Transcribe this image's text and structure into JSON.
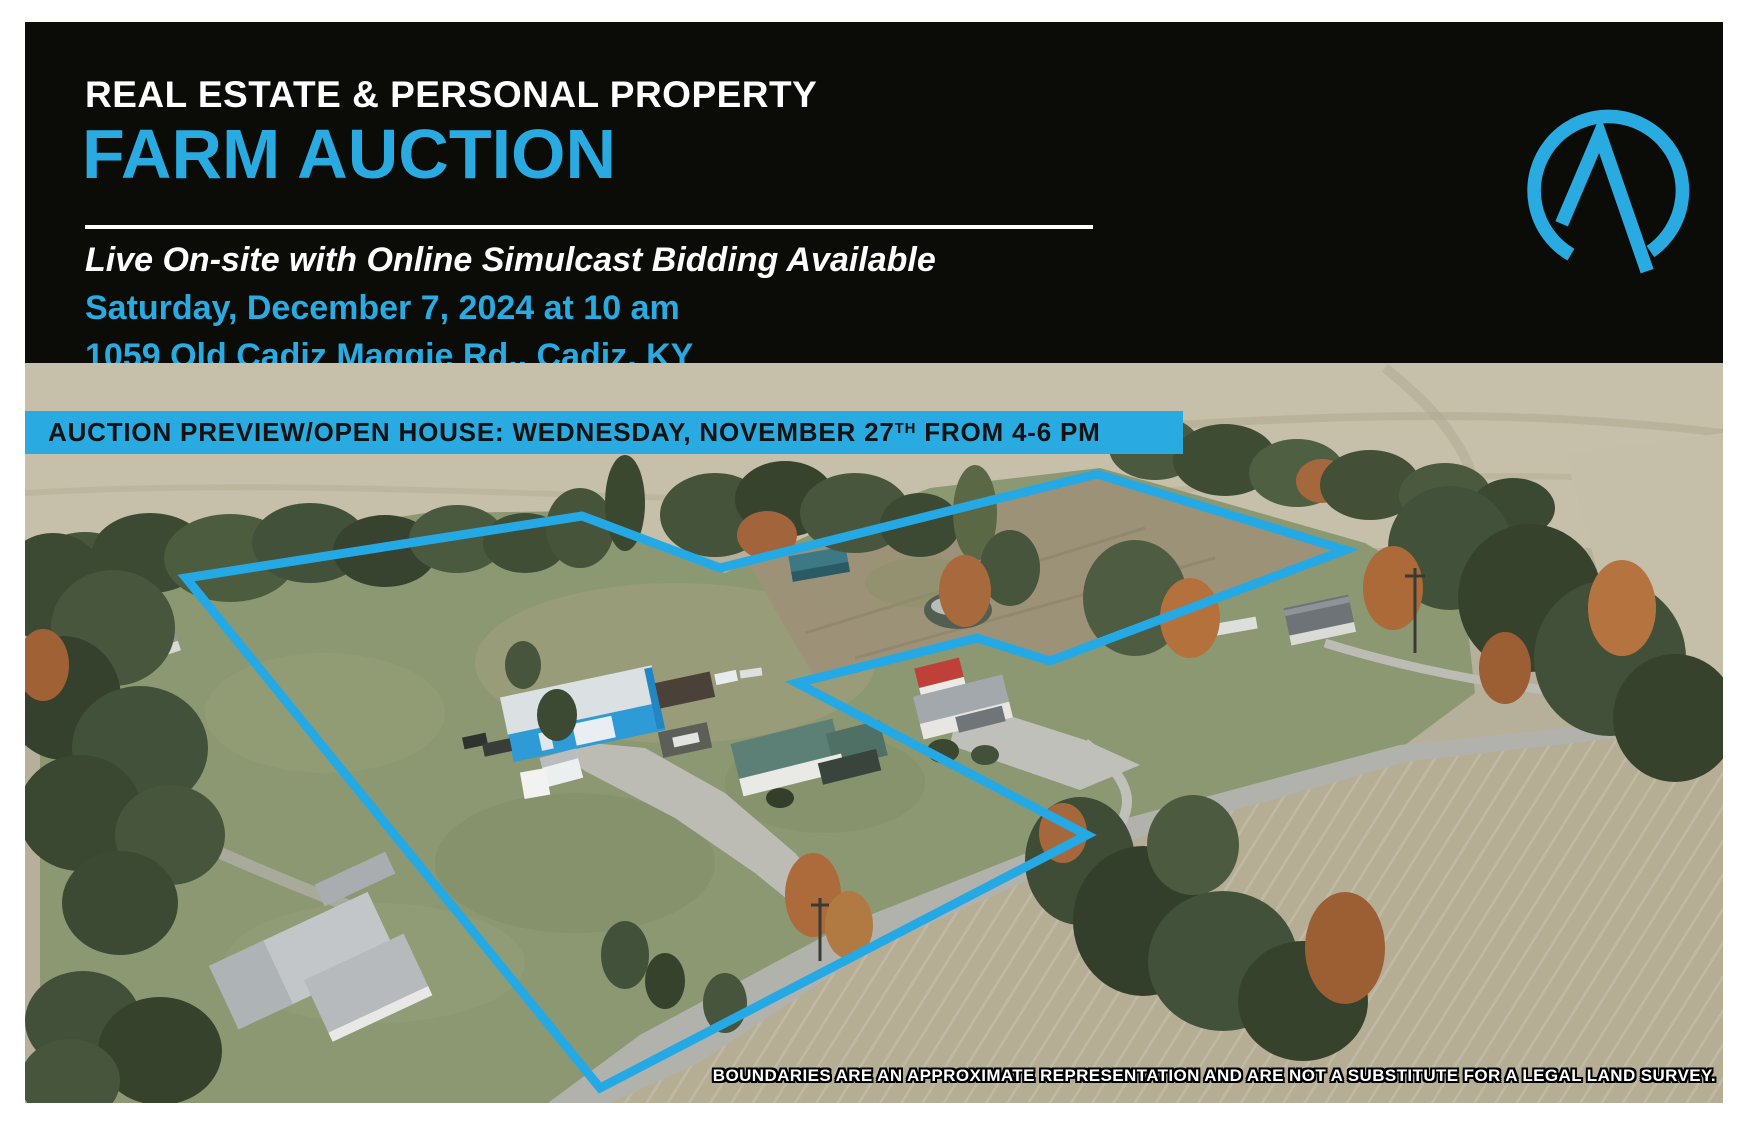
{
  "header": {
    "eyebrow": "REAL ESTATE & PERSONAL PROPERTY",
    "title": "FARM AUCTION",
    "tagline": "Live On-site with Online Simulcast Bidding Available",
    "datetime": "Saturday, December 7, 2024 at 10 am",
    "address": "1059 Old Cadiz Maggie Rd., Cadiz, KY"
  },
  "logo": {
    "icon": "circle-a-auction-mark",
    "color": "#29abe2"
  },
  "banner": {
    "pre": "AUCTION PREVIEW/OPEN HOUSE: WEDNESDAY, NOVEMBER 27",
    "sup": "TH",
    "post": " FROM 4-6 PM"
  },
  "photo": {
    "disclaimer": "BOUNDARIES ARE AN APPROXIMATE REPRESENTATION AND ARE NOT A SUBSTITUTE FOR A LEGAL LAND SURVEY."
  },
  "colors": {
    "accent_blue": "#29abe2",
    "header_bg": "#0b0b08",
    "boundary_blue": "#25a9e4",
    "banner_text": "#121212"
  }
}
